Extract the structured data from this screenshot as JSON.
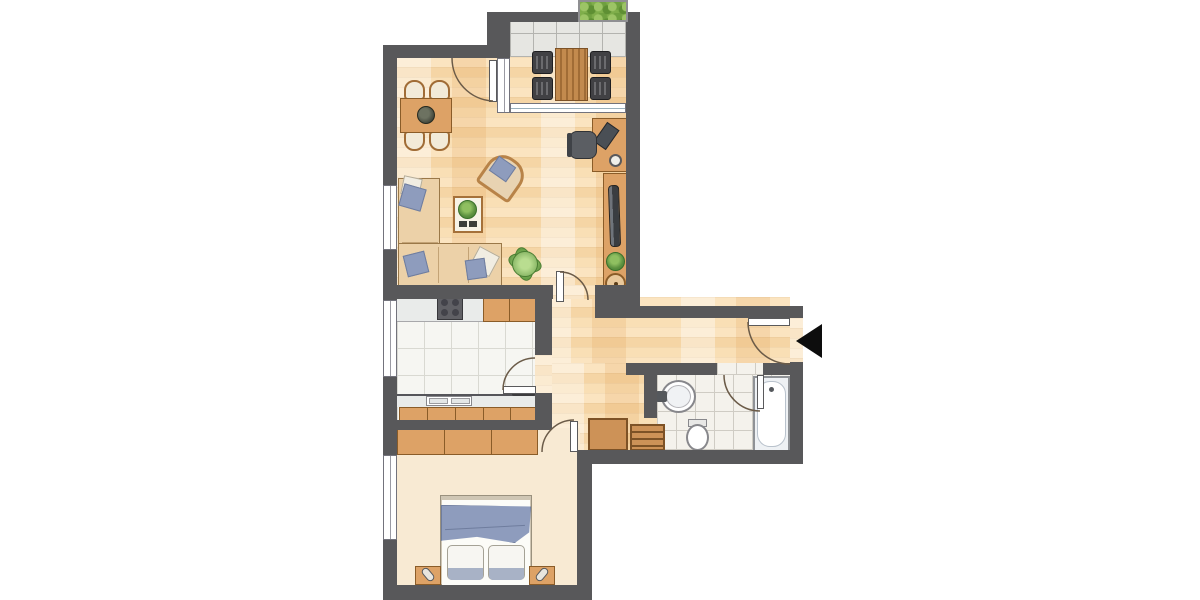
{
  "title": "Apartment floor plan",
  "colors": {
    "wall": "#58585a",
    "furnWood": "#dda266",
    "blue": "#8e9cbd",
    "sofa": "#ecd1a8",
    "counter": "#e9ebea",
    "dark": "#3f4042",
    "hedge": "#7fae4a"
  },
  "rooms": {
    "living": {
      "label": "Living room with dining area and workspace",
      "floor": "wood parquet"
    },
    "balcony": {
      "label": "Balcony with outdoor seating and planter",
      "floor": "grey tiles"
    },
    "kitchen": {
      "label": "Kitchen with counters, stove and sink",
      "floor": "white tiles"
    },
    "hall": {
      "label": "Entrance hall with wardrobe cabinet and shoe rack",
      "floor": "wood parquet"
    },
    "bathroom": {
      "label": "Bathroom with sink, toilet and bathtub",
      "floor": "white tiles"
    },
    "bedroom": {
      "label": "Bedroom with double bed, nightstands and wardrobe",
      "floor": "carpet"
    }
  },
  "furniture": {
    "living": [
      "dining table with four chairs",
      "corner sofa with pillows",
      "coffee table with plant",
      "armchair",
      "floor plant",
      "desk with office chair, laptop and lamp",
      "sideboard with TV, plant and bowl"
    ],
    "balcony": [
      "slatted table",
      "four chairs",
      "planter box"
    ],
    "kitchen": [
      "stove",
      "upper counter with cabinets",
      "lower counter with double sink",
      "base cabinets"
    ],
    "hall": [
      "cabinet",
      "slatted shoe rack"
    ],
    "bathroom": [
      "wash basin",
      "toilet",
      "bathtub"
    ],
    "bedroom": [
      "double bed with blue blanket and two pillows",
      "two nightstands with lamps",
      "three-door wardrobe"
    ]
  },
  "entrance": {
    "marker": "black arrow pointing at apartment entrance door"
  }
}
